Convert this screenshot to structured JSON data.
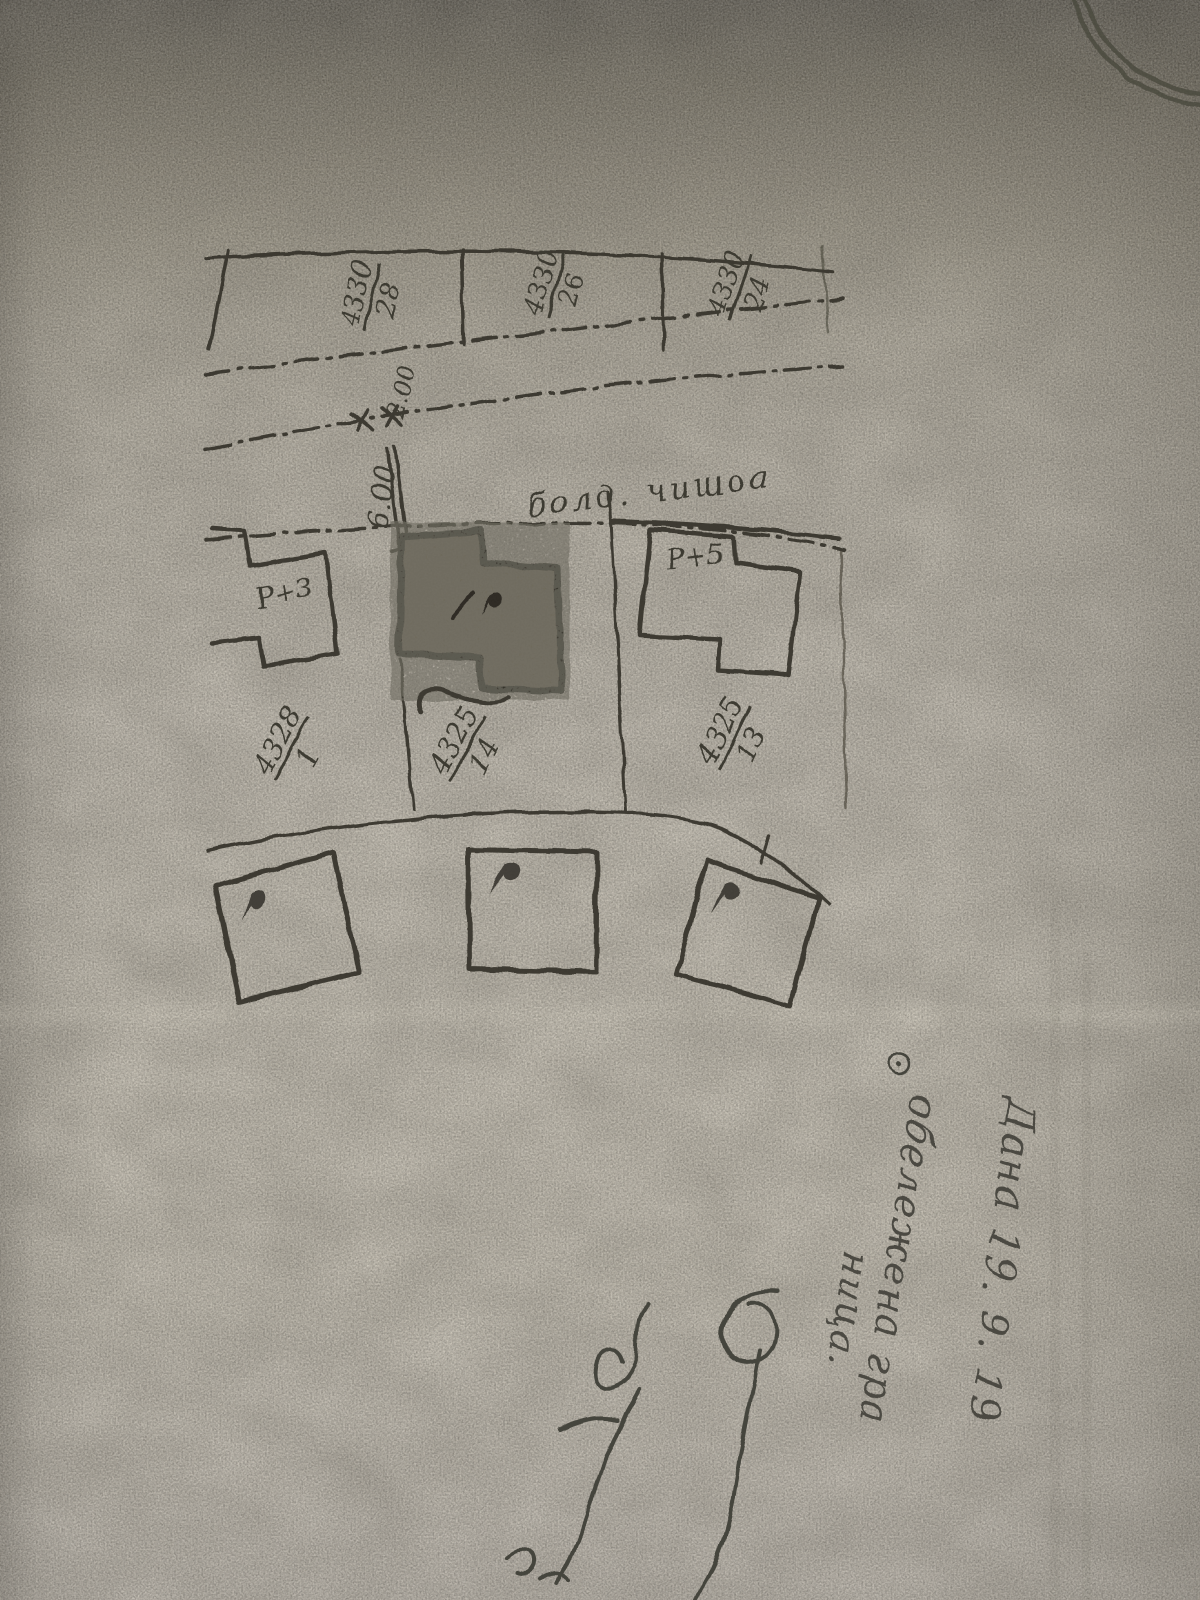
{
  "plan": {
    "street_label": "болд. чишоа",
    "top_parcels": [
      {
        "num": "4330",
        "den": "28"
      },
      {
        "num": "4330",
        "den": "26"
      },
      {
        "num": "4330",
        "den": "24"
      }
    ],
    "mid_parcels": [
      {
        "num": "4328",
        "den": "1"
      },
      {
        "num": "4325",
        "den": "14"
      },
      {
        "num": "4325",
        "den": "13"
      }
    ],
    "buildings": [
      {
        "label": "Р+3"
      },
      {
        "label": "Р+5"
      }
    ],
    "dimensions": [
      {
        "value": "2.00"
      },
      {
        "value": "6.00"
      }
    ]
  },
  "annotations": {
    "date_line": "Дана 19. 9. 19",
    "note_line_1": "обележена гра",
    "note_line_2": "ница."
  },
  "colors": {
    "paper": "#c5bfb3",
    "paper_dark": "#67635a",
    "ink": "#35332a",
    "pencil": "#45443c"
  }
}
